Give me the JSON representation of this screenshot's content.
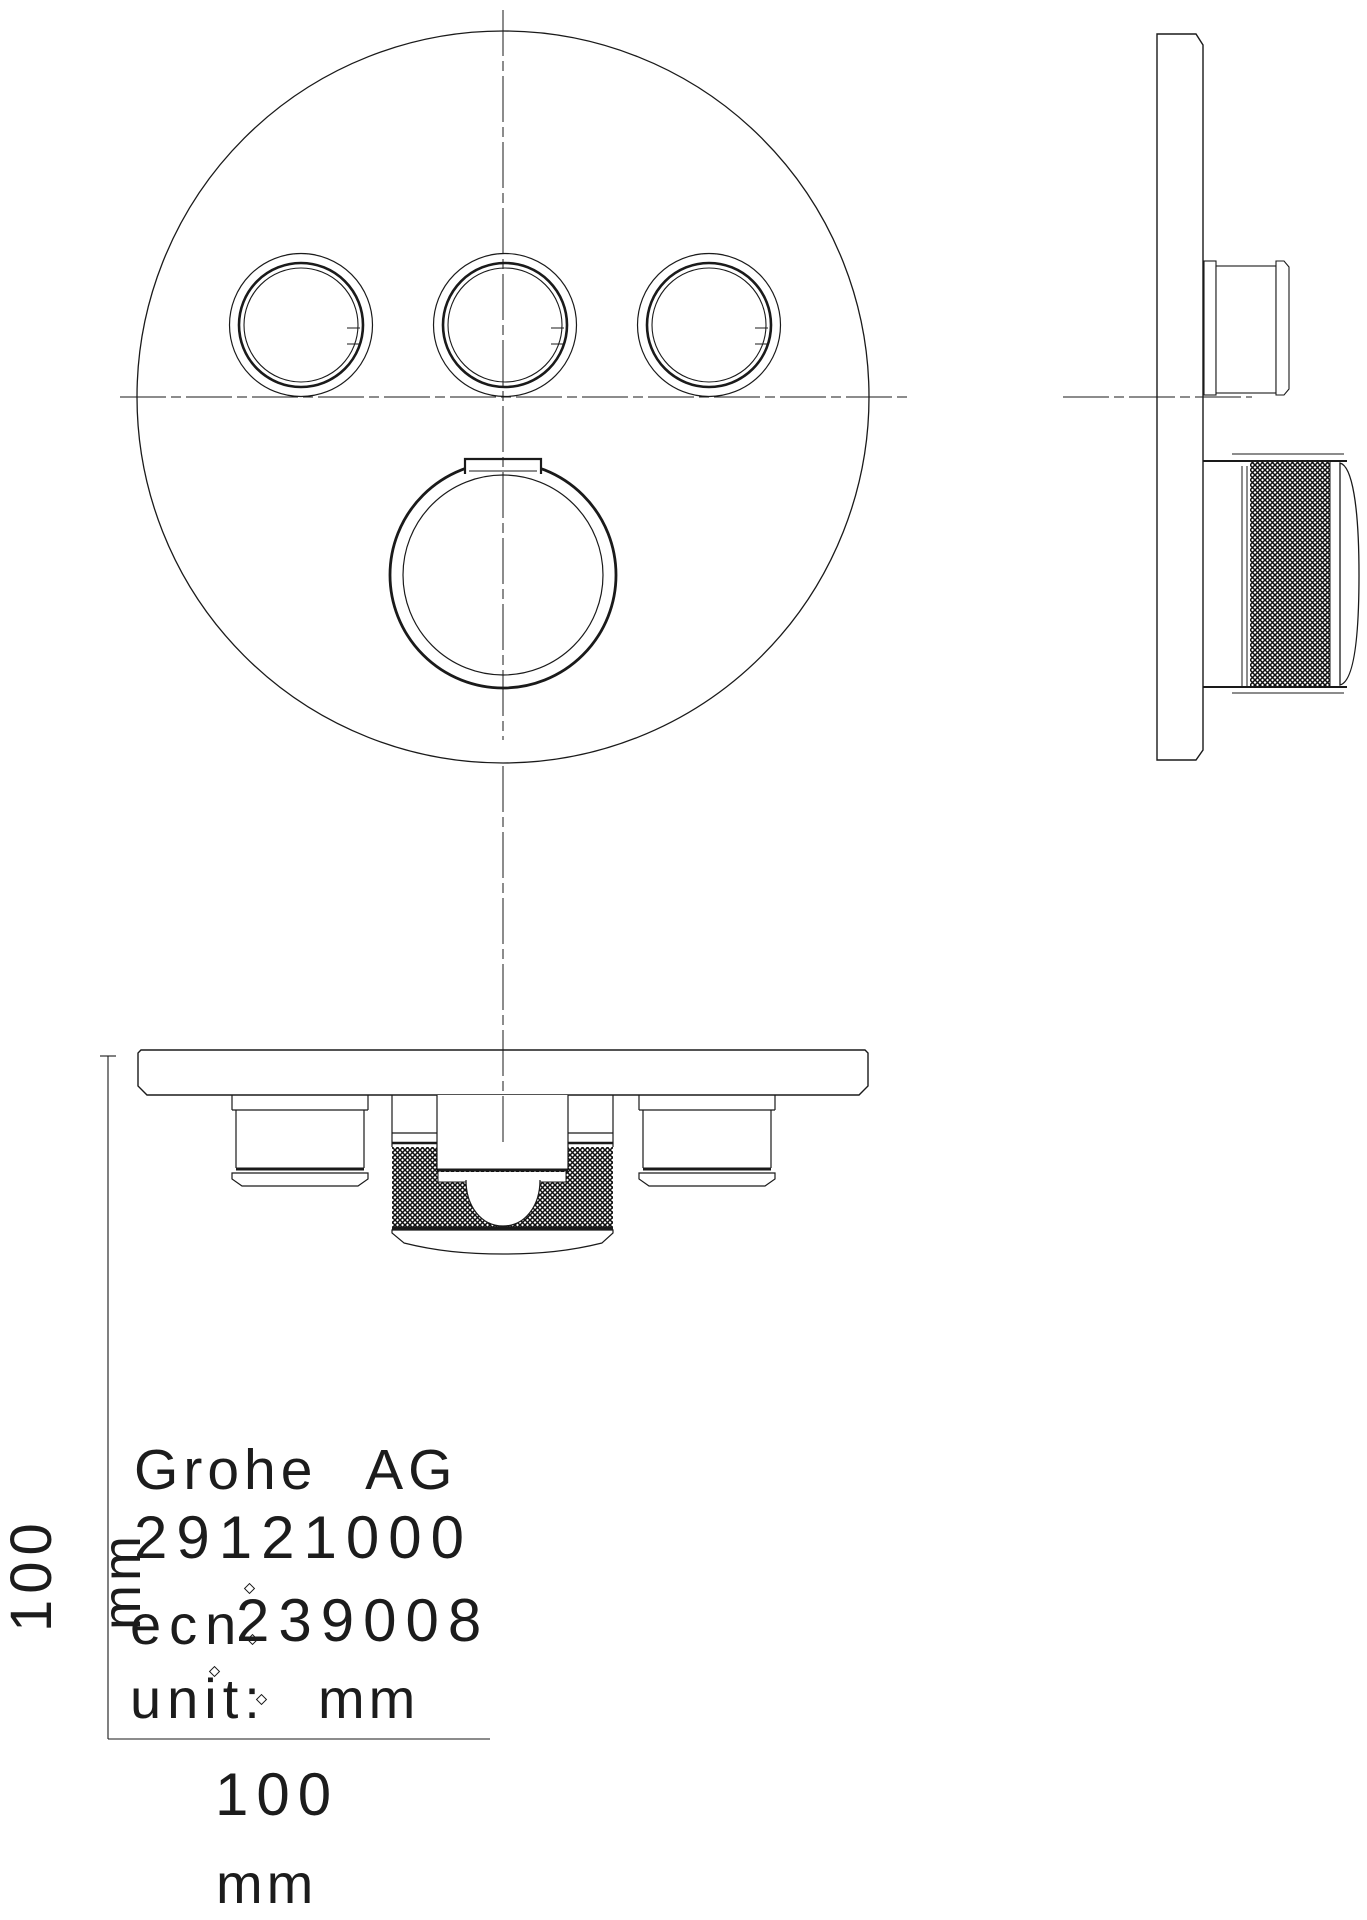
{
  "page": {
    "background_color": "#ffffff",
    "line_color": "#1a1a1a"
  },
  "title_block": {
    "manufacturer": "Grohe AG",
    "product_number": "29121000",
    "ecn_label": "ecn",
    "ecn_number": "239008",
    "unit_label": "unit:",
    "unit_value": "mm"
  },
  "dimensions": {
    "horizontal": {
      "value": "100",
      "unit": "mm"
    },
    "vertical": {
      "value": "100",
      "unit": "mm"
    }
  }
}
